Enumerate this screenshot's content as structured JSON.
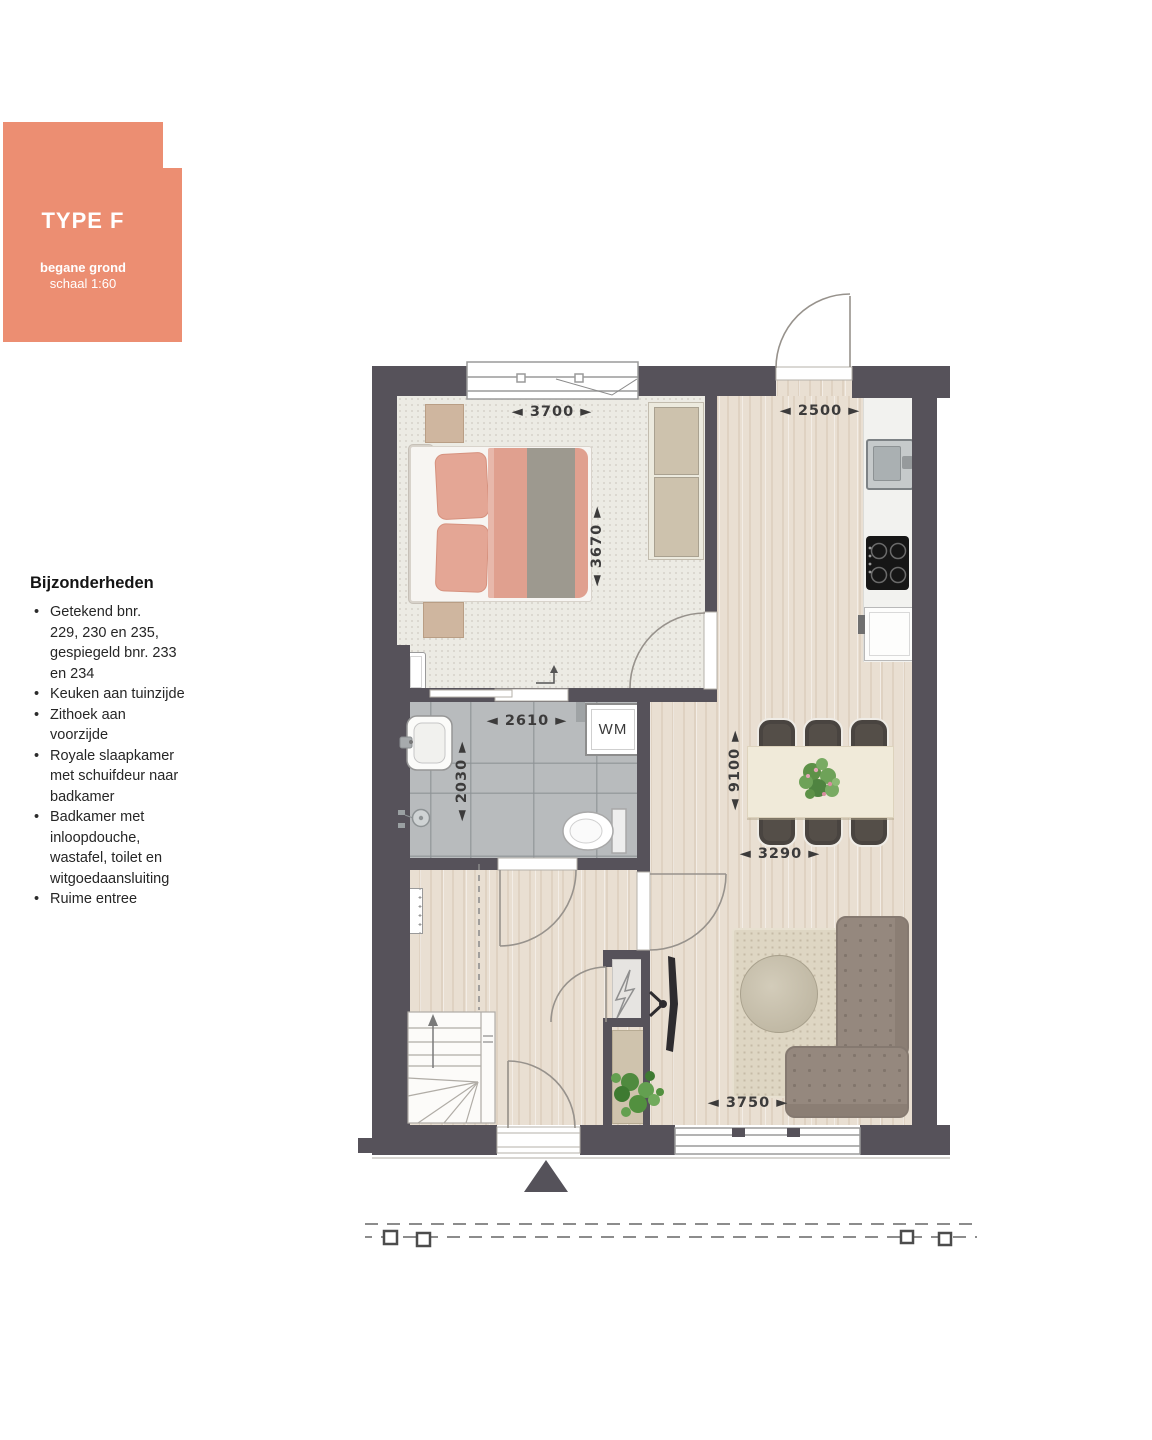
{
  "panel": {
    "type_label": "TYPE F",
    "floor_label": "begane grond",
    "scale_label": "schaal 1:60",
    "accent_color": "#EC8E72"
  },
  "features": {
    "heading": "Bijzonderheden",
    "items": [
      "Getekend bnr.\n229, 230 en 235,\ngespiegeld bnr. 233\nen 234",
      "Keuken aan tuinzijde",
      "Zithoek aan\nvoorzijde",
      "Royale slaapkamer\nmet schuifdeur naar\nbadkamer",
      "Badkamer met\ninloopdouche,\nwastafel, toilet en\nwitgoedaansluiting",
      "Ruime entree"
    ]
  },
  "plan": {
    "dims": {
      "bedroom_width": "◄ 3700 ►",
      "kitchen_width": "◄ 2500 ►",
      "bedroom_depth": "◄ 3670 ►",
      "bathroom_width": "◄ 2610 ►",
      "bathroom_depth": "◄ 2030 ►",
      "living_depth": "◄ 9100 ►",
      "dining_width": "◄ 3290 ►",
      "living_width": "◄ 3750 ►"
    },
    "labels": {
      "washing_machine": "WM"
    },
    "colors": {
      "wall": "#56525A",
      "accent": "#EC8E72"
    }
  }
}
